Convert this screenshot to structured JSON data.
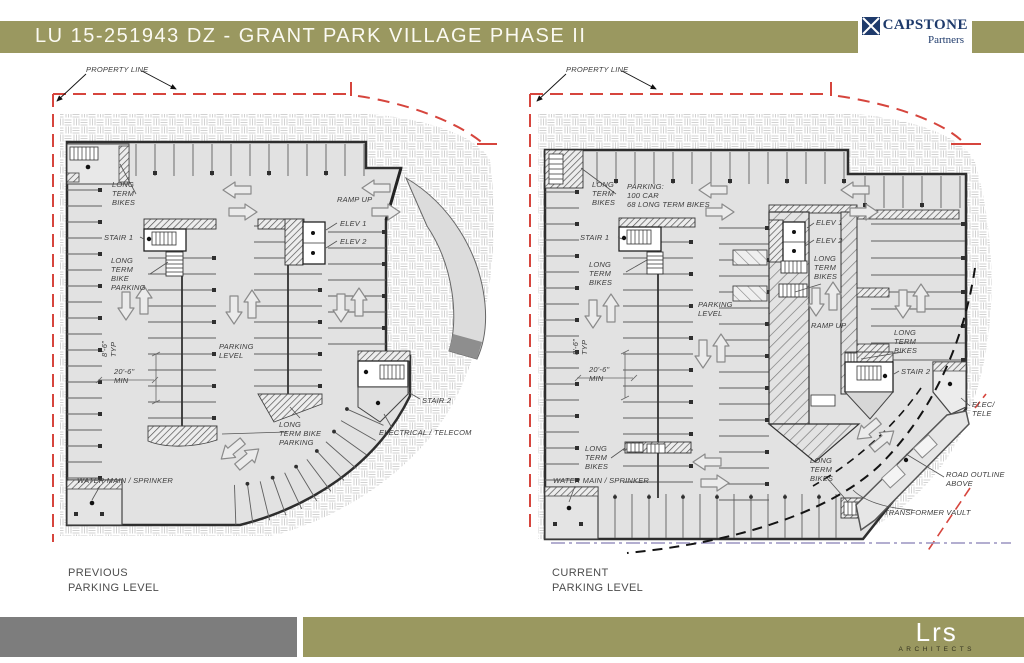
{
  "header": {
    "title": "LU 15-251943 DZ - GRANT PARK VILLAGE PHASE II"
  },
  "logos": {
    "capstone": {
      "name": "CAPSTONE",
      "sub": "Partners"
    },
    "lrs": {
      "name": "Lrs",
      "sub": "ARCHITECTS"
    }
  },
  "colors": {
    "accent_olive": "#9a9860",
    "footer_gray": "#7d7d7d",
    "navy": "#1e3a6b",
    "red_property_line": "#d6453d",
    "building_fill": "#e2e2e2",
    "outline": "#2e2e2e"
  },
  "plans": [
    {
      "id": "previous",
      "caption": {
        "line1": "PREVIOUS",
        "line2": "PARKING LEVEL"
      },
      "annotations": [
        {
          "t": [
            "PROPERTY LINE"
          ],
          "x": 46,
          "y": 3
        },
        {
          "t": [
            "LONG",
            "TERM",
            "BIKES"
          ],
          "x": 72,
          "y": 118
        },
        {
          "t": [
            "STAIR 1"
          ],
          "x": 64,
          "y": 171
        },
        {
          "t": [
            "LONG",
            "TERM",
            "BIKE",
            "PARKING"
          ],
          "x": 71,
          "y": 194
        },
        {
          "t": [
            "RAMP UP"
          ],
          "x": 297,
          "y": 133
        },
        {
          "t": [
            "ELEV 1"
          ],
          "x": 300,
          "y": 157
        },
        {
          "t": [
            "ELEV 2"
          ],
          "x": 300,
          "y": 175
        },
        {
          "t": [
            "8'-6\"",
            "TYP"
          ],
          "x": 60,
          "y": 295,
          "r": -90
        },
        {
          "t": [
            "20'-6\"",
            "MIN"
          ],
          "x": 74,
          "y": 305
        },
        {
          "t": [
            "PARKING",
            "LEVEL"
          ],
          "x": 179,
          "y": 280
        },
        {
          "t": [
            "LONG",
            "TERM BIKE",
            "PARKING"
          ],
          "x": 239,
          "y": 358
        },
        {
          "t": [
            "STAIR 2"
          ],
          "x": 382,
          "y": 334
        },
        {
          "t": [
            "ELECTRICAL / TELECOM"
          ],
          "x": 339,
          "y": 366
        },
        {
          "t": [
            "WATER MAIN / SPRINKER"
          ],
          "x": 37,
          "y": 414
        }
      ]
    },
    {
      "id": "current",
      "caption": {
        "line1": "CURRENT",
        "line2": "PARKING LEVEL"
      },
      "annotations": [
        {
          "t": [
            "PROPERTY LINE"
          ],
          "x": 43,
          "y": 3
        },
        {
          "t": [
            "LONG",
            "TERM",
            "BIKES"
          ],
          "x": 69,
          "y": 118
        },
        {
          "t": [
            "PARKING:",
            "100 CAR",
            "68 LONG TERM BIKES"
          ],
          "x": 104,
          "y": 120
        },
        {
          "t": [
            "STAIR 1"
          ],
          "x": 57,
          "y": 171
        },
        {
          "t": [
            "LONG",
            "TERM",
            "BIKES"
          ],
          "x": 66,
          "y": 198
        },
        {
          "t": [
            "ELEV 1"
          ],
          "x": 293,
          "y": 156
        },
        {
          "t": [
            "ELEV 2"
          ],
          "x": 293,
          "y": 174
        },
        {
          "t": [
            "LONG",
            "TERM",
            "BIKES"
          ],
          "x": 291,
          "y": 192
        },
        {
          "t": [
            "PARKING",
            "LEVEL"
          ],
          "x": 175,
          "y": 238
        },
        {
          "t": [
            "RAMP UP"
          ],
          "x": 288,
          "y": 259
        },
        {
          "t": [
            "LONG",
            "TERM",
            "BIKES"
          ],
          "x": 371,
          "y": 266
        },
        {
          "t": [
            "STAIR 2"
          ],
          "x": 378,
          "y": 305
        },
        {
          "t": [
            "8'-6\"",
            "TYP"
          ],
          "x": 48,
          "y": 293,
          "r": -90
        },
        {
          "t": [
            "20'-6\"",
            "MIN"
          ],
          "x": 66,
          "y": 303
        },
        {
          "t": [
            "LONG",
            "TERM",
            "BIKES"
          ],
          "x": 62,
          "y": 382
        },
        {
          "t": [
            "LONG",
            "TERM",
            "BIKES"
          ],
          "x": 287,
          "y": 394
        },
        {
          "t": [
            "WATER MAIN / SPRINKER"
          ],
          "x": 30,
          "y": 414
        },
        {
          "t": [
            "ELEC/",
            "TELE"
          ],
          "x": 449,
          "y": 338
        },
        {
          "t": [
            "ROAD OUTLINE",
            "ABOVE"
          ],
          "x": 423,
          "y": 408
        },
        {
          "t": [
            "TRANSFORMER VAULT"
          ],
          "x": 361,
          "y": 446
        }
      ]
    }
  ]
}
